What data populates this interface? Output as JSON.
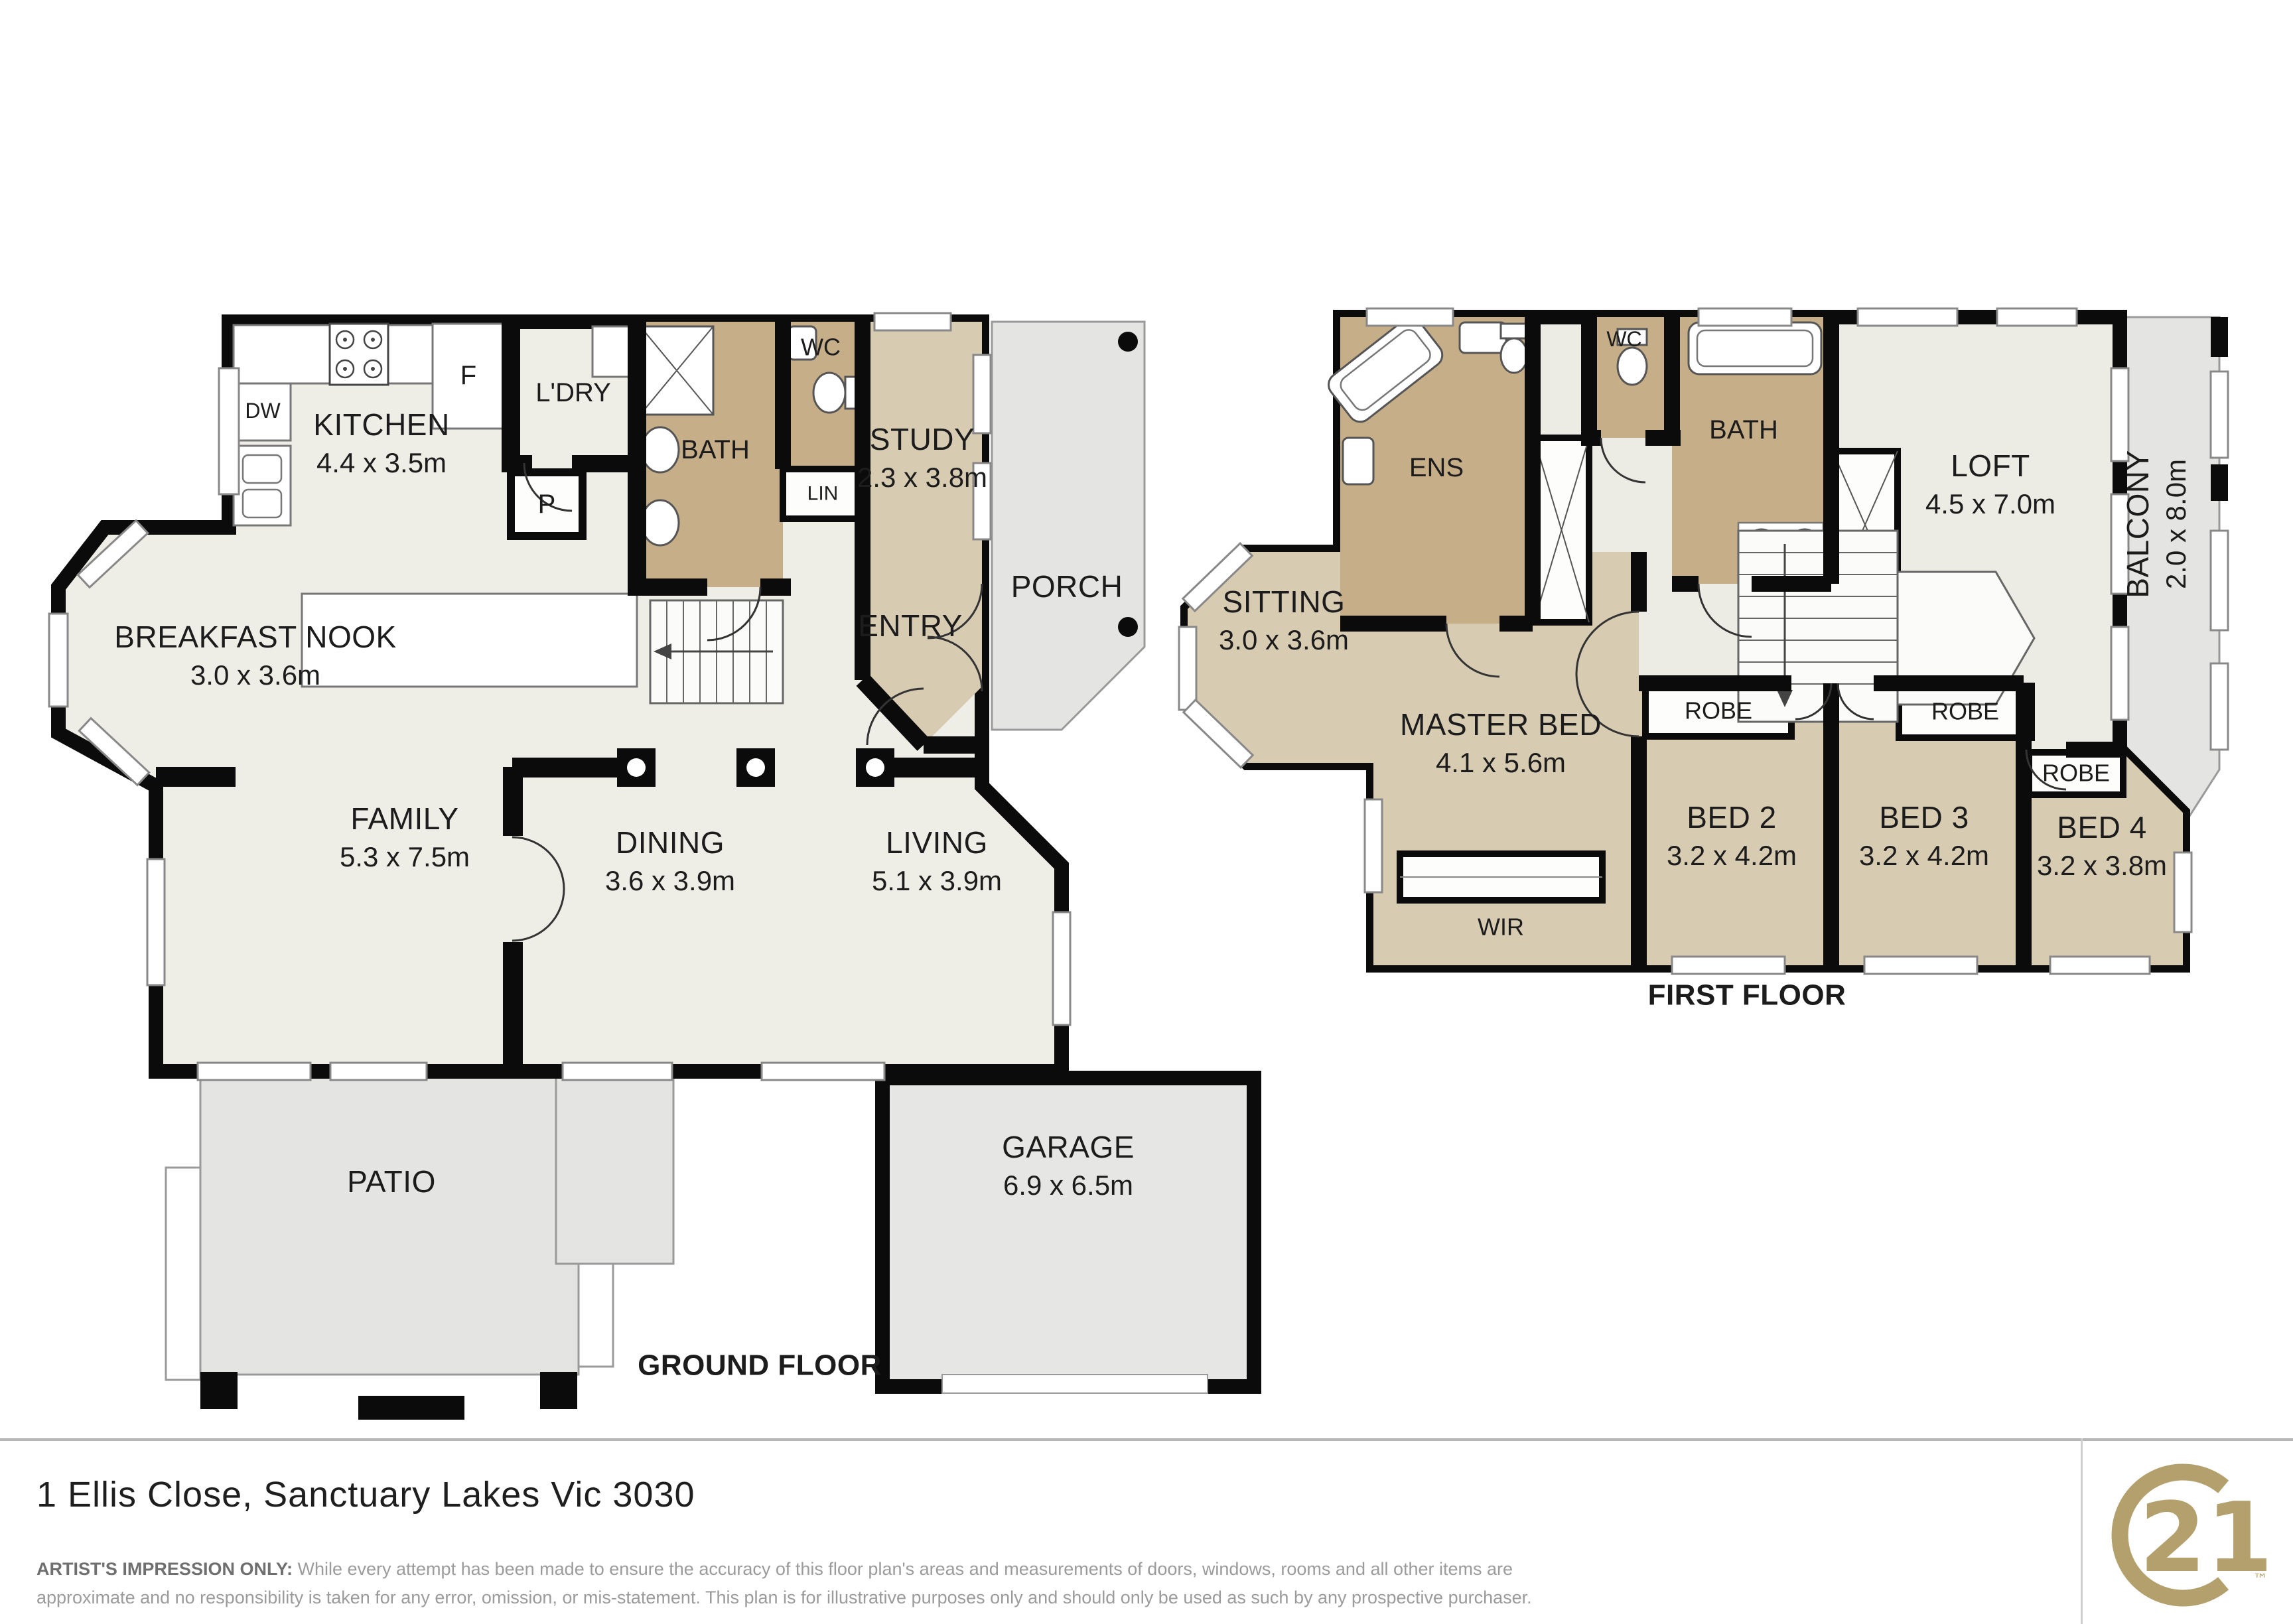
{
  "address_bar": {
    "address": "1 Ellis Close, Sanctuary Lakes Vic 3030",
    "disclaimer_prefix": "ARTIST'S IMPRESSION ONLY:",
    "disclaimer_line1": "While every attempt has been made to ensure the accuracy of this floor plan's areas and measurements of doors, windows, rooms and all other items are",
    "disclaimer_line2": "approximate and no responsibility is taken for any error, omission, or mis-statement. This plan is for illustrative purposes only and should only be used as such by any prospective purchaser.",
    "logo": {
      "brand": "Century 21",
      "number": "21",
      "trademark": "™",
      "color": "#b3a06c"
    }
  },
  "ground_floor": {
    "title": "GROUND FLOOR",
    "rooms": {
      "kitchen": {
        "name": "KITCHEN",
        "dims": "4.4 x 3.5m"
      },
      "fridge": "F",
      "dishwasher": "DW",
      "laundry": "L'DRY",
      "pantry": "P",
      "bath": "BATH",
      "wc": "WC",
      "linen": "LIN",
      "study": {
        "name": "STUDY",
        "dims": "2.3 x 3.8m"
      },
      "porch": "PORCH",
      "entry": "ENTRY",
      "breakfast_nook": {
        "name": "BREAKFAST NOOK",
        "dims": "3.0 x 3.6m"
      },
      "family": {
        "name": "FAMILY",
        "dims": "5.3 x 7.5m"
      },
      "dining": {
        "name": "DINING",
        "dims": "3.6 x 3.9m"
      },
      "living": {
        "name": "LIVING",
        "dims": "5.1 x 3.9m"
      },
      "patio": "PATIO",
      "garage": {
        "name": "GARAGE",
        "dims": "6.9 x 6.5m"
      }
    }
  },
  "first_floor": {
    "title": "FIRST FLOOR",
    "rooms": {
      "sitting": {
        "name": "SITTING",
        "dims": "3.0 x 3.6m"
      },
      "ensuite": "ENS",
      "wc": "WC",
      "bath": "BATH",
      "loft": {
        "name": "LOFT",
        "dims": "4.5 x 7.0m"
      },
      "balcony": {
        "name": "BALCONY",
        "dims": "2.0 x 8.0m"
      },
      "master_bed": {
        "name": "MASTER BED",
        "dims": "4.1 x 5.6m"
      },
      "robe_bed2": "ROBE",
      "bed2": {
        "name": "BED 2",
        "dims": "3.2 x 4.2m"
      },
      "robe_bed3": "ROBE",
      "bed3": {
        "name": "BED 3",
        "dims": "3.2 x 4.2m"
      },
      "robe_bed4": "ROBE",
      "bed4": {
        "name": "BED 4",
        "dims": "3.2 x 3.8m"
      },
      "wir": "WIR"
    }
  },
  "colors": {
    "floor": "#efeee6",
    "room_tan": "#d7cbb2",
    "wet_tan": "#c6ae89",
    "outdoor": "#e4e4e2",
    "wall": "#0b0b0b",
    "text": "#1c1c1c",
    "muted": "#9b9b9b",
    "gold": "#b3a06c"
  }
}
